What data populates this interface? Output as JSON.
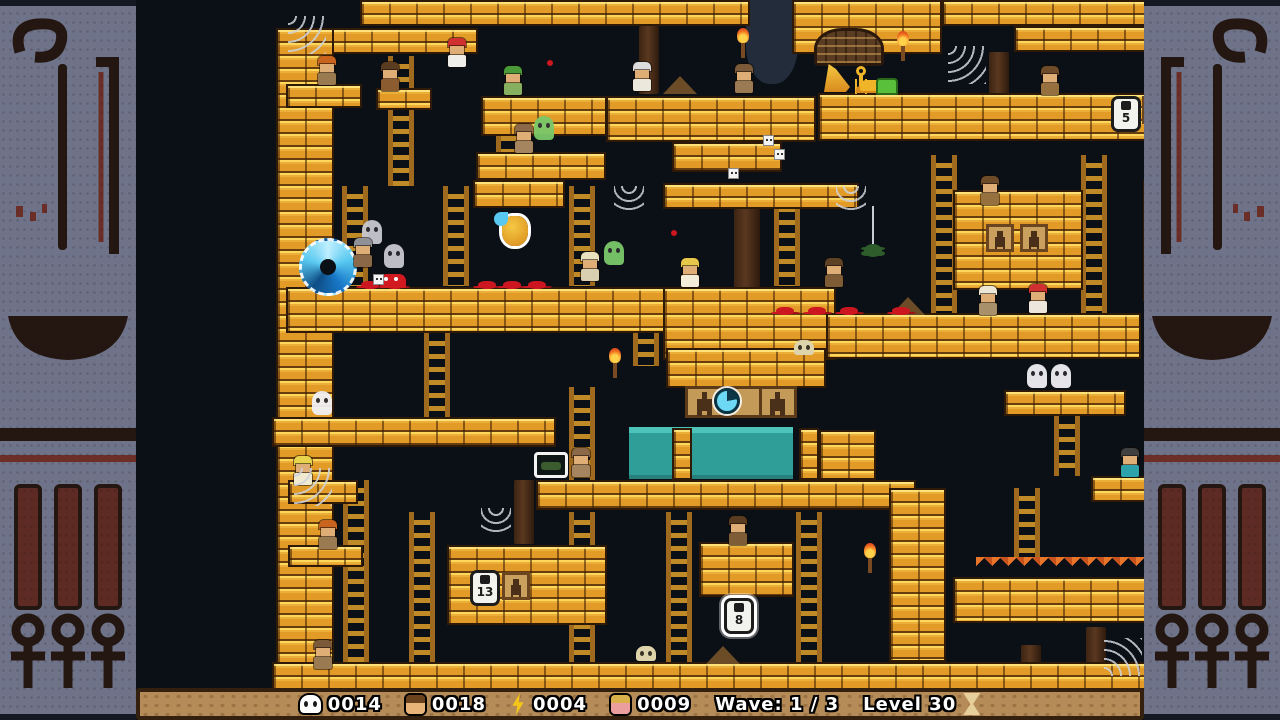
{
  "hud": {
    "skull_count": "0014",
    "boy_count": "0018",
    "bolt_count": "0004",
    "girl_count": "0009",
    "wave_label": "Wave: 1 / 3",
    "level_label": "Level 30",
    "icons": {
      "skull": "skull-icon",
      "boy": "boy-face-icon",
      "bolt": "lightning-icon",
      "girl": "girl-face-icon",
      "hourglass": "hourglass-icon"
    }
  },
  "colors": {
    "brick": "#e39b27",
    "brick_highlight": "#ffd75a",
    "background": "#0b1016",
    "border_panel": "#6f7389",
    "glyph_dark": "#241712",
    "glyph_red": "#6b2f28",
    "water": "#2f9e98",
    "hud_bar": "#b58b57",
    "blood": "#cc1620",
    "portal_blue": "#58c8f0"
  },
  "level": {
    "platforms": [
      [
        224,
        0,
        390,
        26
      ],
      [
        656,
        0,
        150,
        54
      ],
      [
        806,
        0,
        234,
        26
      ],
      [
        878,
        26,
        210,
        26
      ],
      [
        1023,
        20,
        65,
        74
      ],
      [
        152,
        28,
        190,
        26
      ],
      [
        140,
        28,
        58,
        660
      ],
      [
        1100,
        0,
        44,
        688
      ],
      [
        150,
        84,
        76,
        24
      ],
      [
        240,
        88,
        56,
        22
      ],
      [
        345,
        96,
        126,
        40
      ],
      [
        340,
        152,
        130,
        28
      ],
      [
        470,
        96,
        210,
        46
      ],
      [
        536,
        142,
        110,
        30
      ],
      [
        682,
        93,
        341,
        48
      ],
      [
        337,
        180,
        92,
        28
      ],
      [
        527,
        183,
        196,
        26
      ],
      [
        817,
        190,
        130,
        100
      ],
      [
        1007,
        180,
        36,
        122
      ],
      [
        150,
        287,
        473,
        46
      ],
      [
        527,
        287,
        173,
        73
      ],
      [
        690,
        313,
        315,
        46
      ],
      [
        136,
        417,
        284,
        30
      ],
      [
        152,
        480,
        70,
        24
      ],
      [
        530,
        348,
        160,
        40
      ],
      [
        683,
        430,
        57,
        50
      ],
      [
        400,
        480,
        380,
        30
      ],
      [
        536,
        428,
        20,
        52
      ],
      [
        663,
        428,
        20,
        52
      ],
      [
        868,
        390,
        122,
        26
      ],
      [
        1016,
        428,
        72,
        26
      ],
      [
        955,
        476,
        133,
        26
      ],
      [
        311,
        545,
        160,
        80
      ],
      [
        563,
        542,
        95,
        55
      ],
      [
        753,
        488,
        57,
        174
      ],
      [
        817,
        577,
        193,
        46
      ],
      [
        152,
        545,
        75,
        22
      ],
      [
        136,
        662,
        1008,
        28
      ]
    ],
    "ladders": [
      [
        252,
        56,
        26,
        130
      ],
      [
        360,
        128,
        26,
        56
      ],
      [
        206,
        186,
        26,
        100
      ],
      [
        307,
        186,
        26,
        100
      ],
      [
        433,
        186,
        26,
        100
      ],
      [
        638,
        186,
        26,
        100
      ],
      [
        795,
        155,
        26,
        158
      ],
      [
        945,
        155,
        26,
        158
      ],
      [
        1066,
        62,
        26,
        300
      ],
      [
        288,
        333,
        26,
        86
      ],
      [
        497,
        318,
        26,
        48
      ],
      [
        433,
        387,
        26,
        93
      ],
      [
        207,
        480,
        26,
        208
      ],
      [
        273,
        512,
        26,
        178
      ],
      [
        433,
        512,
        26,
        176
      ],
      [
        530,
        512,
        26,
        166
      ],
      [
        660,
        512,
        26,
        166
      ],
      [
        918,
        416,
        26,
        60
      ],
      [
        1050,
        428,
        26,
        234
      ],
      [
        878,
        488,
        26,
        70
      ]
    ],
    "pillars": [
      [
        503,
        26,
        20,
        68
      ],
      [
        598,
        209,
        26,
        80
      ],
      [
        853,
        52,
        20,
        44
      ],
      [
        378,
        480,
        20,
        64
      ],
      [
        950,
        627,
        20,
        46
      ],
      [
        885,
        645,
        20,
        25
      ]
    ],
    "entities": [
      {
        "t": "stalactite",
        "name": "cave-stalactite",
        "x": 610,
        "y": 0,
        "w": 52,
        "h": 84
      },
      {
        "t": "water",
        "name": "water-pool",
        "x": 493,
        "y": 427,
        "w": 164,
        "h": 52
      },
      {
        "t": "tile-row",
        "name": "glyph-tile-row",
        "x": 549,
        "y": 386,
        "w": 112,
        "h": 32
      },
      {
        "t": "clock",
        "name": "timer-clock",
        "x": 578,
        "y": 388
      },
      {
        "t": "web",
        "v": "tl",
        "x": 152,
        "y": 16
      },
      {
        "t": "web",
        "v": "tl",
        "x": 812,
        "y": 46
      },
      {
        "t": "web",
        "v": "tr",
        "x": 1073,
        "y": 48
      },
      {
        "t": "web",
        "v": "tl",
        "x": 158,
        "y": 468
      },
      {
        "t": "web",
        "v": "tr",
        "x": 1012,
        "y": 525
      },
      {
        "t": "web",
        "v": "bl",
        "x": 968,
        "y": 638
      },
      {
        "t": "web",
        "v": "hang",
        "x": 478,
        "y": 186
      },
      {
        "t": "web",
        "v": "hang",
        "x": 700,
        "y": 186
      },
      {
        "t": "web",
        "v": "hang",
        "x": 345,
        "y": 508
      },
      {
        "t": "spider",
        "name": "green-spider",
        "x": 728,
        "y": 244,
        "th": 38
      },
      {
        "t": "spider",
        "name": "green-spider",
        "x": 1016,
        "y": 552,
        "th": 28
      },
      {
        "t": "torch",
        "x": 602,
        "y": 28
      },
      {
        "t": "torch",
        "x": 762,
        "y": 31
      },
      {
        "t": "torch",
        "x": 474,
        "y": 348
      },
      {
        "t": "torch",
        "x": 729,
        "y": 543
      },
      {
        "t": "torch",
        "x": 1038,
        "y": 358
      },
      {
        "t": "tablet",
        "name": "hieroglyph-tablet",
        "x": 678,
        "y": 28,
        "w": 70,
        "h": 38
      },
      {
        "t": "harp",
        "name": "gold-harp",
        "x": 688,
        "y": 64
      },
      {
        "t": "ankh",
        "name": "gold-ankh",
        "x": 717,
        "y": 66
      },
      {
        "t": "gold-pile",
        "x": 724,
        "y": 80
      },
      {
        "t": "green-chest",
        "x": 740,
        "y": 78
      },
      {
        "t": "lock",
        "name": "numbered-lock",
        "x": 975,
        "y": 96,
        "label": "5"
      },
      {
        "t": "lock",
        "name": "numbered-lock",
        "x": 1040,
        "y": 156,
        "label": "6",
        "v": "glow"
      },
      {
        "t": "lock",
        "name": "numbered-lock",
        "x": 334,
        "y": 570,
        "label": "13"
      },
      {
        "t": "lock",
        "name": "numbered-lock",
        "x": 588,
        "y": 598,
        "label": "8",
        "v": "glow"
      },
      {
        "t": "lock",
        "name": "numbered-lock",
        "x": 1102,
        "y": 634,
        "label": "5",
        "v": "glow"
      },
      {
        "t": "pict-tile",
        "name": "sarcophagus-tile",
        "x": 1006,
        "y": 96
      },
      {
        "t": "pict-tile",
        "name": "sarcophagus-tile",
        "x": 366,
        "y": 572
      },
      {
        "t": "pict-tile",
        "name": "sarcophagus-tile",
        "x": 850,
        "y": 224
      },
      {
        "t": "pict-tile",
        "name": "sarcophagus-tile",
        "x": 884,
        "y": 224
      },
      {
        "t": "honeypot",
        "name": "highlighted-pot",
        "x": 366,
        "y": 216
      },
      {
        "t": "portal",
        "name": "blue-portal",
        "x": 163,
        "y": 238
      },
      {
        "t": "item-box",
        "name": "item-pickup",
        "x": 398,
        "y": 452
      },
      {
        "t": "spikes",
        "name": "fire-spikes",
        "x": 840,
        "y": 557,
        "w": 170,
        "h": 20
      },
      {
        "t": "splat",
        "x": 225,
        "y": 281
      },
      {
        "t": "splat",
        "x": 250,
        "y": 281
      },
      {
        "t": "splat",
        "x": 342,
        "y": 281
      },
      {
        "t": "splat",
        "x": 367,
        "y": 281
      },
      {
        "t": "splat",
        "x": 392,
        "y": 281
      },
      {
        "t": "splat",
        "x": 640,
        "y": 307
      },
      {
        "t": "splat",
        "x": 672,
        "y": 307
      },
      {
        "t": "splat",
        "x": 704,
        "y": 307
      },
      {
        "t": "splat",
        "x": 756,
        "y": 307
      },
      {
        "t": "splat",
        "v": "mini",
        "x": 411,
        "y": 60
      },
      {
        "t": "splat",
        "v": "mini",
        "x": 535,
        "y": 230
      },
      {
        "t": "crab",
        "name": "red-crab",
        "x": 244,
        "y": 274
      },
      {
        "t": "skull",
        "name": "ground-skull",
        "x": 500,
        "y": 646
      },
      {
        "t": "skull",
        "name": "ground-skull",
        "x": 658,
        "y": 340
      },
      {
        "t": "mound",
        "name": "sand-mound",
        "x": 527,
        "y": 76
      },
      {
        "t": "mound",
        "name": "sand-mound",
        "x": 755,
        "y": 297
      },
      {
        "t": "mound",
        "name": "sand-mound",
        "x": 570,
        "y": 646
      },
      {
        "t": "white-box",
        "x": 627,
        "y": 135
      },
      {
        "t": "white-box",
        "x": 638,
        "y": 149
      },
      {
        "t": "white-box",
        "x": 592,
        "y": 168
      },
      {
        "t": "white-box",
        "x": 237,
        "y": 274
      },
      {
        "t": "ghost",
        "name": "gray-ghost",
        "x": 226,
        "y": 220,
        "c1": "#c8c8d0"
      },
      {
        "t": "ghost",
        "name": "gray-ghost",
        "x": 248,
        "y": 244,
        "c1": "#c8c8d0"
      },
      {
        "t": "ghost",
        "name": "white-ghost",
        "x": 891,
        "y": 364,
        "c1": "#f0f0f4"
      },
      {
        "t": "ghost",
        "name": "white-ghost",
        "x": 915,
        "y": 364,
        "c1": "#f0f0f4"
      },
      {
        "t": "ghost",
        "name": "white-ghost",
        "x": 176,
        "y": 391,
        "c1": "#f0f0f4"
      },
      {
        "t": "ghost",
        "name": "green-ghost",
        "x": 398,
        "y": 116,
        "c1": "#7ac86a"
      },
      {
        "t": "ghost",
        "name": "green-ghost",
        "x": 468,
        "y": 241,
        "c1": "#7ac86a"
      },
      {
        "t": "char",
        "name": "hat-explorer",
        "x": 180,
        "y": 56,
        "c1": "#c8641e",
        "c2": "#9a7a50"
      },
      {
        "t": "char",
        "name": "hedgehog-mob",
        "x": 243,
        "y": 62,
        "c1": "#5a3c20",
        "c2": "#8a5c30"
      },
      {
        "t": "char",
        "name": "redhead-girl",
        "x": 310,
        "y": 38,
        "c1": "#d03030",
        "c2": "#f0eee8"
      },
      {
        "t": "char",
        "name": "green-bird",
        "x": 366,
        "y": 66,
        "c1": "#4a9a3a",
        "c2": "#86b060"
      },
      {
        "t": "char",
        "name": "elder-mummy",
        "x": 495,
        "y": 62,
        "c1": "#dcdcdc",
        "c2": "#ece8dc"
      },
      {
        "t": "char",
        "name": "mummy",
        "x": 597,
        "y": 64,
        "c1": "#7a5a38",
        "c2": "#9a7a52"
      },
      {
        "t": "char",
        "name": "mummy",
        "x": 377,
        "y": 124,
        "c1": "#8a6848",
        "c2": "#a48560"
      },
      {
        "t": "char",
        "name": "mace-mummy",
        "x": 216,
        "y": 238,
        "c1": "#909098",
        "c2": "#8a6848"
      },
      {
        "t": "char",
        "name": "blonde-girl",
        "x": 543,
        "y": 258,
        "c1": "#e8c84a",
        "c2": "#f2ecd8"
      },
      {
        "t": "char",
        "name": "bear-mummy",
        "x": 687,
        "y": 258,
        "c1": "#5e4226",
        "c2": "#7d5c36"
      },
      {
        "t": "char",
        "name": "ladder-climber",
        "x": 443,
        "y": 252,
        "c1": "#e8e0be",
        "c2": "#d8d0b0"
      },
      {
        "t": "char",
        "name": "white-hat-man",
        "x": 841,
        "y": 286,
        "c1": "#ece6d4",
        "c2": "#a8906a"
      },
      {
        "t": "char",
        "name": "redhead-man",
        "x": 891,
        "y": 284,
        "c1": "#d03030",
        "c2": "#ece6dc"
      },
      {
        "t": "char",
        "name": "monkey",
        "x": 903,
        "y": 66,
        "c1": "#6e4c2a",
        "c2": "#96703e"
      },
      {
        "t": "char",
        "name": "green-hair-kid",
        "x": 1038,
        "y": 400,
        "c1": "#57b23e",
        "c2": "#c9b192"
      },
      {
        "t": "char",
        "name": "teal-shirt-kid",
        "x": 983,
        "y": 448,
        "c1": "#404040",
        "c2": "#2ea2aa"
      },
      {
        "t": "char",
        "name": "yellow-hair-kid",
        "x": 156,
        "y": 456,
        "c1": "#e8d44d",
        "c2": "#f0ead0"
      },
      {
        "t": "char",
        "name": "hat-explorer",
        "x": 181,
        "y": 520,
        "c1": "#c8641e",
        "c2": "#9a7a50"
      },
      {
        "t": "char",
        "name": "mummy",
        "x": 176,
        "y": 640,
        "c1": "#7a5a38",
        "c2": "#9a7a52"
      },
      {
        "t": "char",
        "name": "mummy",
        "x": 434,
        "y": 448,
        "c1": "#8a6848",
        "c2": "#a48560"
      },
      {
        "t": "char",
        "name": "peeking-head",
        "x": 591,
        "y": 516,
        "c1": "#5a3c20",
        "c2": "#7d5c36"
      },
      {
        "t": "char",
        "name": "peeking-head",
        "x": 843,
        "y": 176,
        "c1": "#6e4c2a",
        "c2": "#96703e"
      }
    ]
  }
}
